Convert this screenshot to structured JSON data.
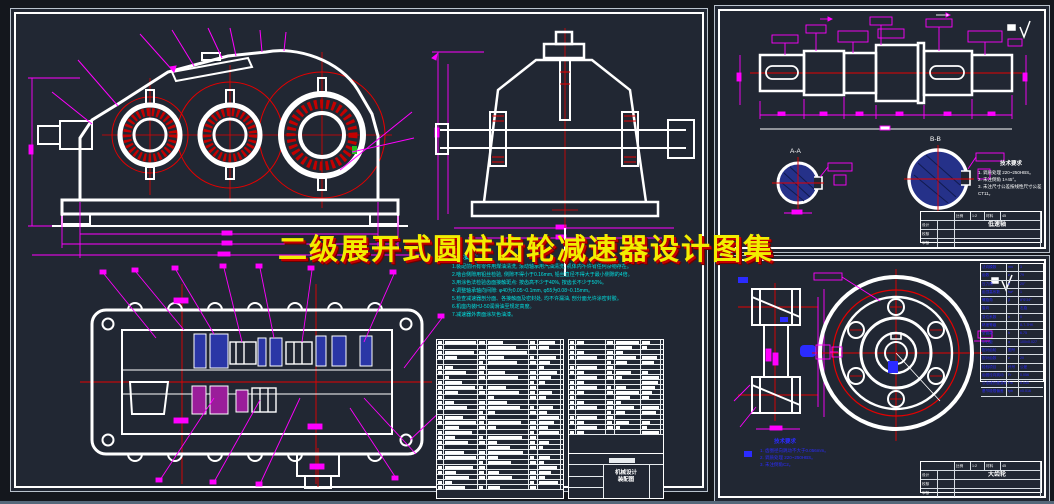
{
  "title_overlay": {
    "text": "二级展开式圆柱齿轮减速器设计图集",
    "color": "#f2ee00",
    "shadow_color": "#c40000"
  },
  "left_sheet": {
    "tech_notes": {
      "header": "技术要求:",
      "lines": [
        "1.装配前所有零件用煤油清洗, 滚动轴承用汽油清洗, 机体内不许有任何杂物存在。",
        "2.啮合侧隙用铅丝检验, 侧隙不得小于0.16mm, 铅丝直径不得大于最小侧隙的4倍。",
        "3.用涂色法检验齿面接触斑点: 按齿高不少于40%, 按齿长不少于50%。",
        "4.调整轴承轴向间隙: φ40为0.05~0.1mm, φ55为0.08~0.15mm。",
        "5.检查减速器剖分面、各接触面及密封处, 均不许漏油, 剖分面允许涂密封胶。",
        "6.机座内装HJ-50润滑油至规定高度。",
        "7.减速器外表面涂灰色油漆。"
      ]
    },
    "bom_title_lines": [
      "机械设计",
      "装配图"
    ]
  },
  "shaft_sheet": {
    "section_a_label": "A-A",
    "section_b_label": "B-B",
    "tech_notes": {
      "header": "技术要求",
      "lines": [
        "1. 调质处理 220~250HBS。",
        "2. 未注倒角 1×45°。",
        "3. 未注尺寸公差按线性尺寸公差CT11。"
      ]
    },
    "title_block": {
      "part_name": "低速轴",
      "rows": [
        "设计",
        "校核",
        "审核"
      ],
      "top_cells": [
        "比例",
        "1:2",
        "材料",
        "45"
      ]
    }
  },
  "gear_sheet": {
    "tech_notes": {
      "header": "技术要求",
      "lines": [
        "1. 齿圈径向跳动不大于0.056mm。",
        "2. 调质处理 220~250HBS。",
        "3. 未注倒角C2。"
      ]
    },
    "param_rows": [
      [
        "法向模数",
        "mn",
        "3"
      ],
      [
        "齿数",
        "z",
        "79"
      ],
      [
        "压力角",
        "α",
        "20°"
      ],
      [
        "齿顶高系数",
        "ha*",
        "1"
      ],
      [
        "螺旋角",
        "β",
        "8°6′34″"
      ],
      [
        "旋向",
        "",
        "右旋"
      ],
      [
        "变位系数",
        "x",
        "0"
      ],
      [
        "精度等级",
        "",
        "8-7-7HK"
      ],
      [
        "全齿高",
        "h",
        "6.75"
      ],
      [
        "中心距",
        "a",
        "100±0.027"
      ],
      [
        "配对齿轮",
        "图号",
        ""
      ],
      [
        "配对齿数",
        "z",
        "20"
      ],
      [
        "检验项目",
        "代号",
        "公差"
      ],
      [
        "齿圈径向跳动",
        "Fr",
        "0.056"
      ],
      [
        "公法线长度变动",
        "Fw",
        "0.040"
      ],
      [
        "基节极限偏差",
        "fpb",
        "±0.016"
      ]
    ],
    "title_block": {
      "part_name": "大齿轮",
      "rows": [
        "设计",
        "校核",
        "审核"
      ],
      "top_cells": [
        "比例",
        "1:2",
        "材料",
        "45"
      ]
    }
  }
}
